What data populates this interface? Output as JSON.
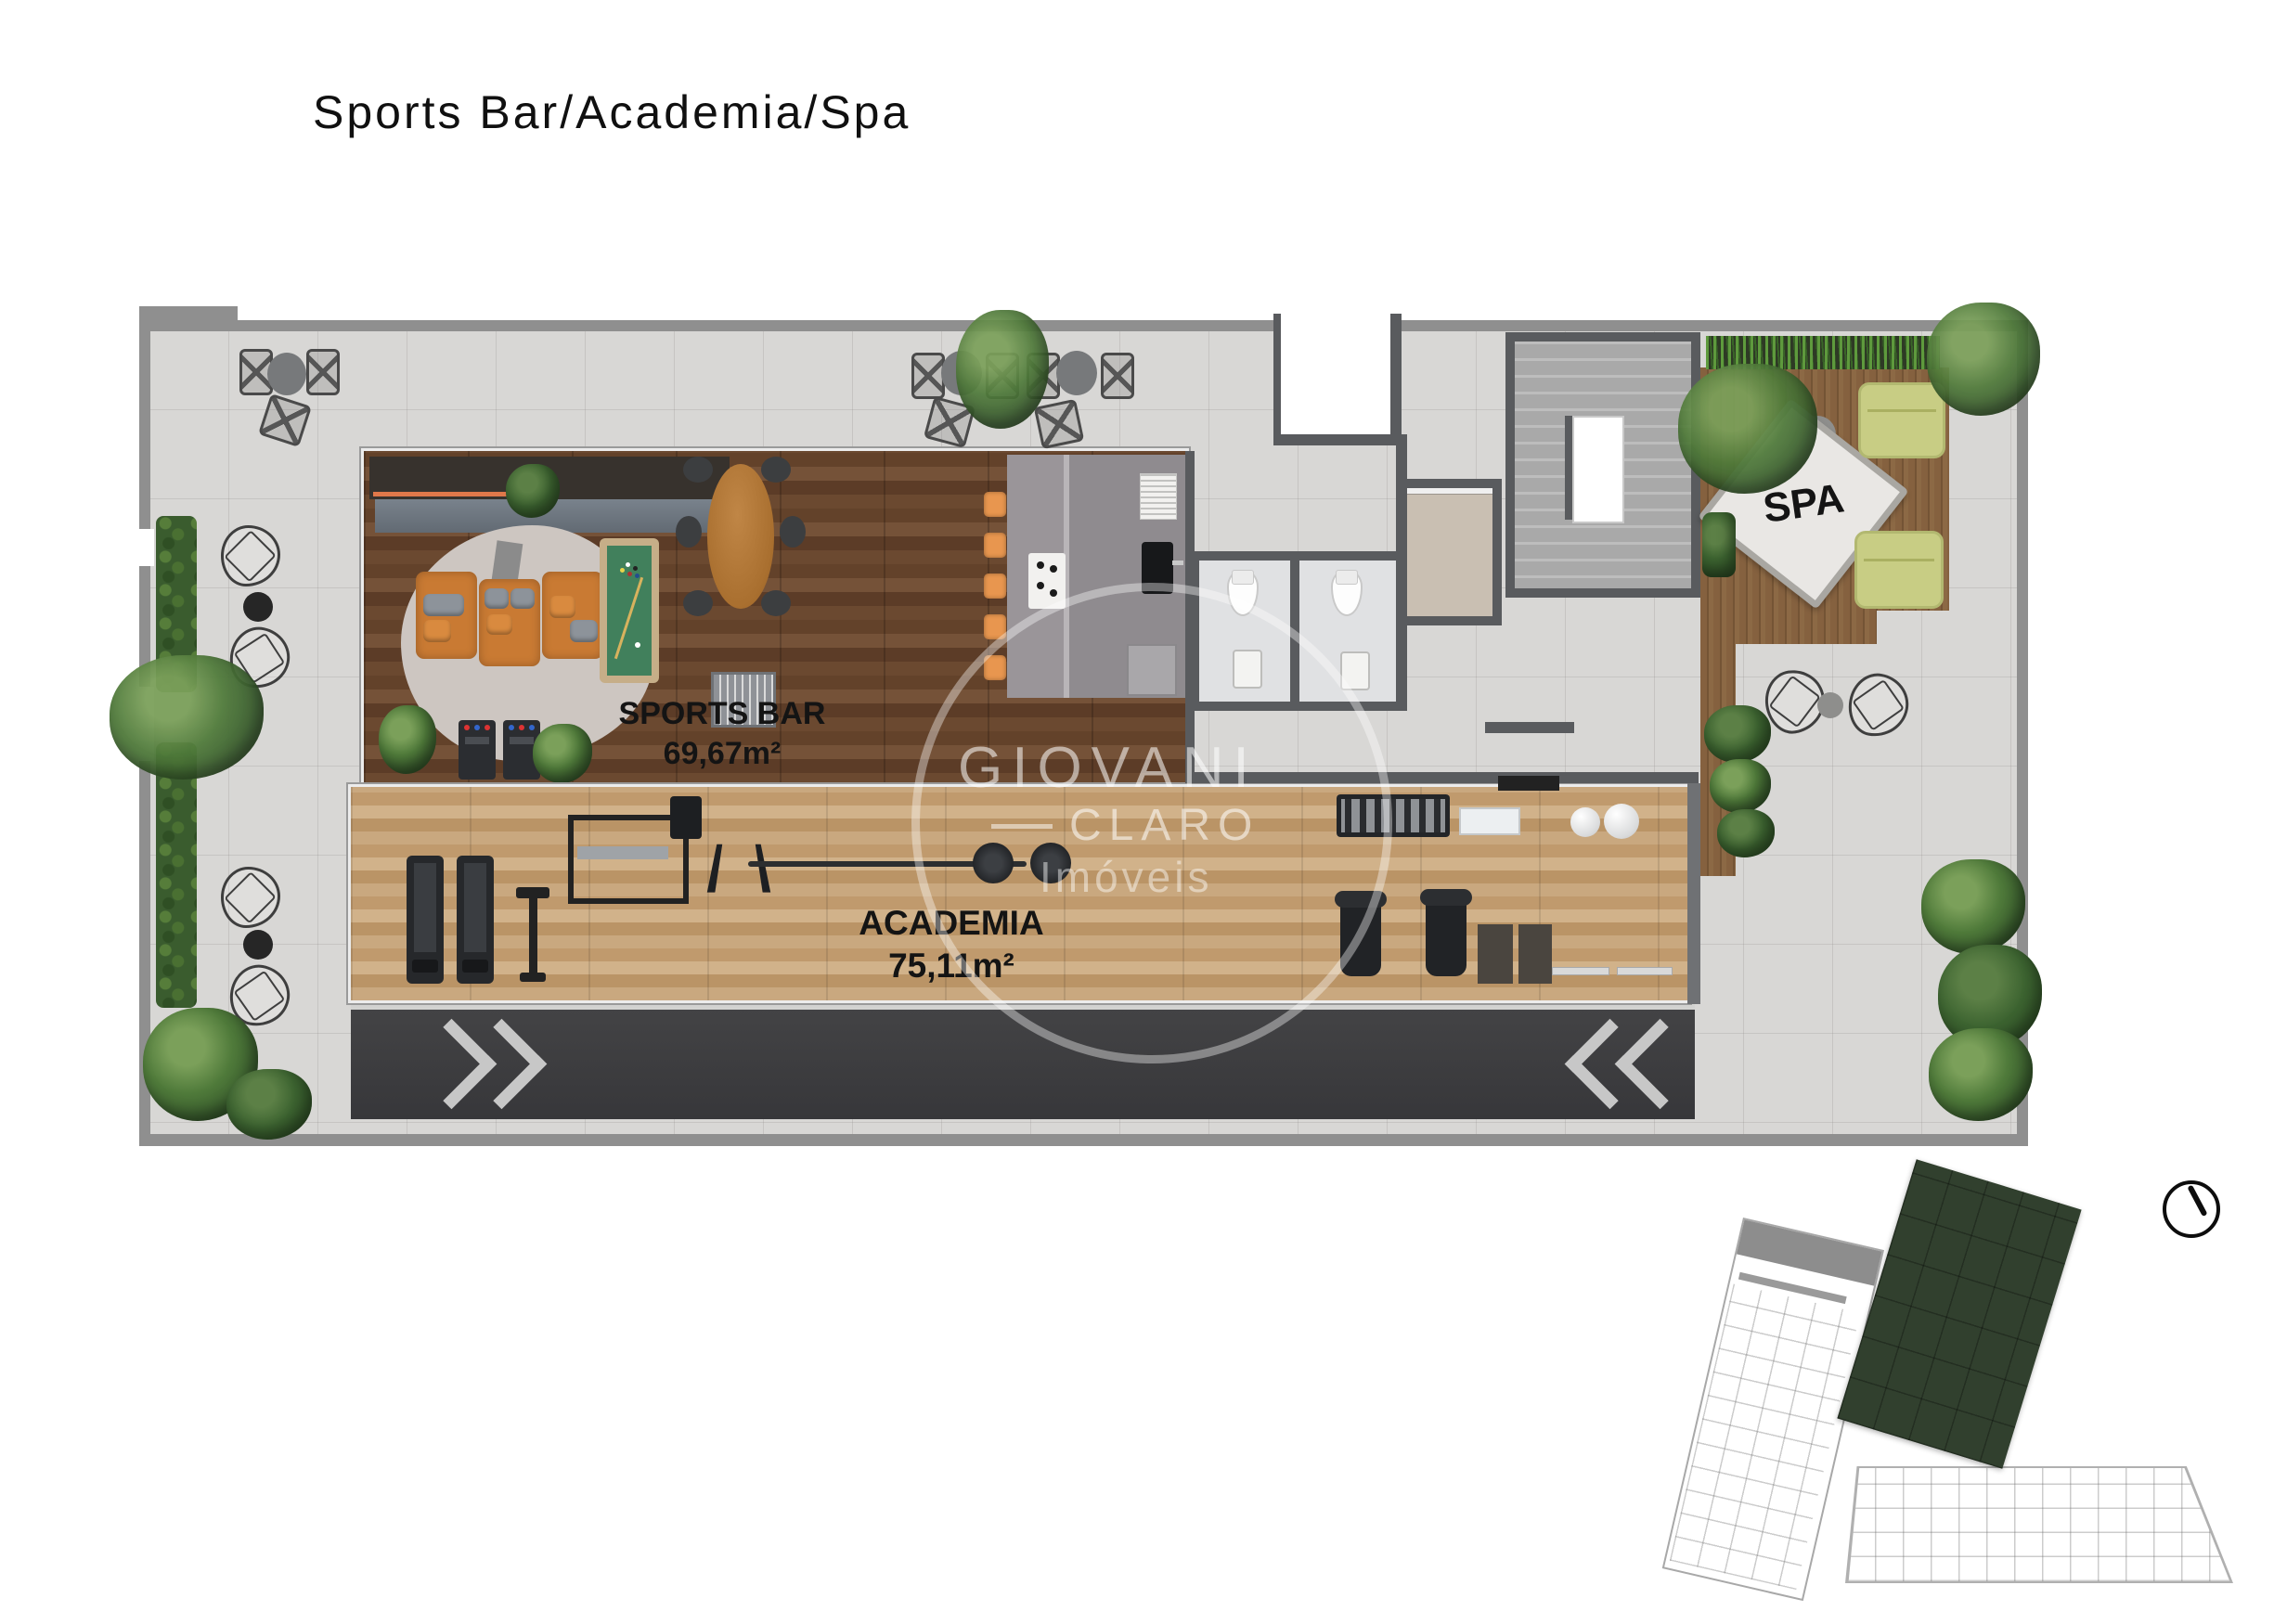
{
  "title": "Sports Bar/Academia/Spa",
  "labels": {
    "sports_bar": {
      "name": "SPORTS BAR",
      "area": "69,67m²"
    },
    "academia": {
      "name": "ACADEMIA",
      "area": "75,11m²"
    },
    "spa": {
      "name": "SPA"
    }
  },
  "watermark": {
    "brand_top": "GIOVANI",
    "brand_bottom": "CLARO",
    "tagline": "Imóveis"
  },
  "colors": {
    "sports_bar_wood": "#66452e",
    "gym_wood": "#c4a078",
    "spa_deck_wood": "#7f5d3c",
    "terrace_tile": "#d8d7d5",
    "driveway": "#3e3e40",
    "sofa_orange": "#c97a33",
    "stool_orange": "#e8964f",
    "pool_felt": "#41805c",
    "lounger_green": "#c8cd84",
    "keyplan_highlight": "#31402e",
    "label_text": "#141414"
  }
}
